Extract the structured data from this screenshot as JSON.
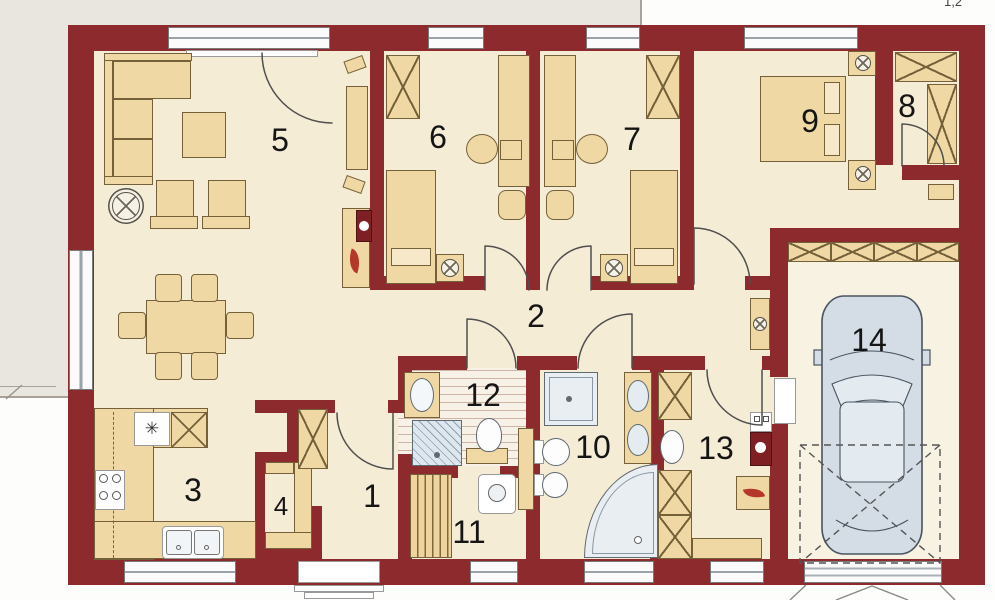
{
  "corner_note": "1,2",
  "rooms": [
    {
      "number": "1"
    },
    {
      "number": "2"
    },
    {
      "number": "3"
    },
    {
      "number": "4"
    },
    {
      "number": "5"
    },
    {
      "number": "6"
    },
    {
      "number": "7"
    },
    {
      "number": "8"
    },
    {
      "number": "9"
    },
    {
      "number": "10"
    },
    {
      "number": "11"
    },
    {
      "number": "12"
    },
    {
      "number": "13"
    },
    {
      "number": "14"
    }
  ],
  "icons": {
    "fridge_star": "✳"
  },
  "colors": {
    "wall": "#8c2a2e",
    "floor": "#f5ecd6",
    "furniture": "#f0d8a4",
    "fixture": "#e9eef3",
    "terrace": "#e9e6e0",
    "car": "#d4dde5",
    "flame": "#b5372a"
  }
}
